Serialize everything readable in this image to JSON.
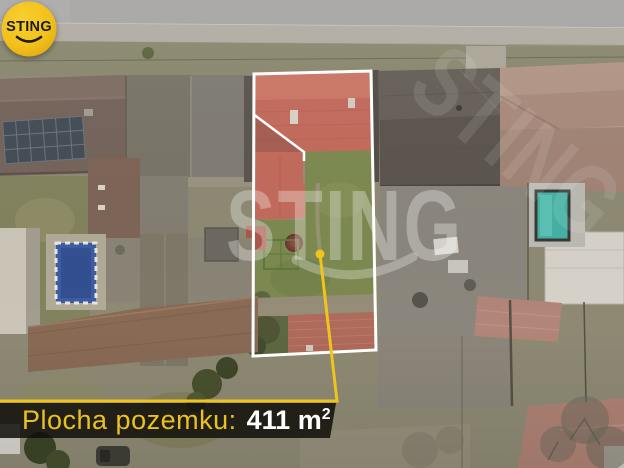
{
  "banner": {
    "label": "Plocha pozemku:",
    "value": "411",
    "unit": "m",
    "exponent": "2"
  },
  "logo": {
    "text": "STING"
  },
  "watermark": {
    "text": "STING"
  },
  "colors": {
    "accent_yellow": "#f0c41d",
    "plot_outline": "#ffffff",
    "banner_background": "rgba(16,14,9,0.85)",
    "banner_label": "#e9c120",
    "banner_value": "#ffffff",
    "logo_circle": "#f1c01b",
    "logo_text": "#1d1d1b",
    "highlight_roof": "#c26a5b",
    "garden_green": "#7c894f"
  }
}
